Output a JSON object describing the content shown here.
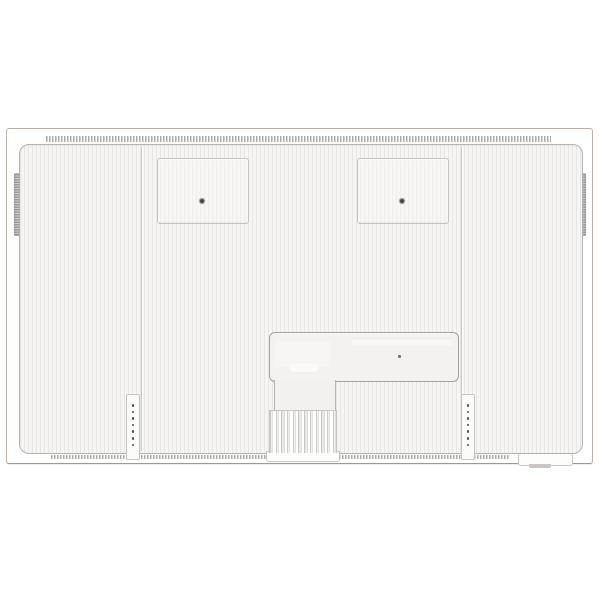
{
  "scene": {
    "type": "product-photo",
    "description": "Rear view of a white flat-screen television: ribbed white back panel inside a thin tan frame, two square VESA mount covers with center screws, a recessed I/O compartment at lower center, a finned stand-mount column below it, two vertical speaker-hole strips, dashed vent grilles along top and bottom edges, grip tabs on both sides and a small connector notch at bottom right.",
    "background_color": "#ffffff",
    "visible_text": ""
  },
  "palette": {
    "frame-edge": "#c7ae92",
    "frame-bottom": "#9d9a95",
    "panel-bg": "#f6f5f3",
    "rib": "#e7e6e4",
    "panel-border": "#b6b4b1",
    "seam": "#ccc9c6",
    "dash": "#9b9b9b",
    "vesa-border": "#c5c3c1",
    "screw": "#454545",
    "screw-ring": "#a9a8a6",
    "io-border": "#a2a19f",
    "io-bg": "#f3f2f0",
    "strip-bg": "#fbfbfa",
    "strip-border": "#c7c5c3",
    "hole": "#4f4f4f",
    "fin-dark": "#b5b4b2",
    "fin-light": "#f4f3f1",
    "grip-light": "#cdcdcd",
    "grip-dark": "#9e9e9e",
    "tab": "#c9c6c2"
  },
  "tv": {
    "vesa_mount_covers": {
      "count": 2,
      "screws_per_cover": 1
    },
    "panel_seams": {
      "count": 2
    },
    "side_grips": {
      "count": 2
    },
    "speaker_strips": {
      "count": 2,
      "holes_per_strip": 7
    },
    "heatsink": {
      "fin_count": 12
    },
    "io_compartment": {
      "slots": 1,
      "label_stickers": 1,
      "screw_dots": 1
    },
    "vents": {
      "top": 1,
      "bottom": 1
    },
    "bottom_right_notch": {
      "count": 1,
      "tab_count": 1
    }
  }
}
